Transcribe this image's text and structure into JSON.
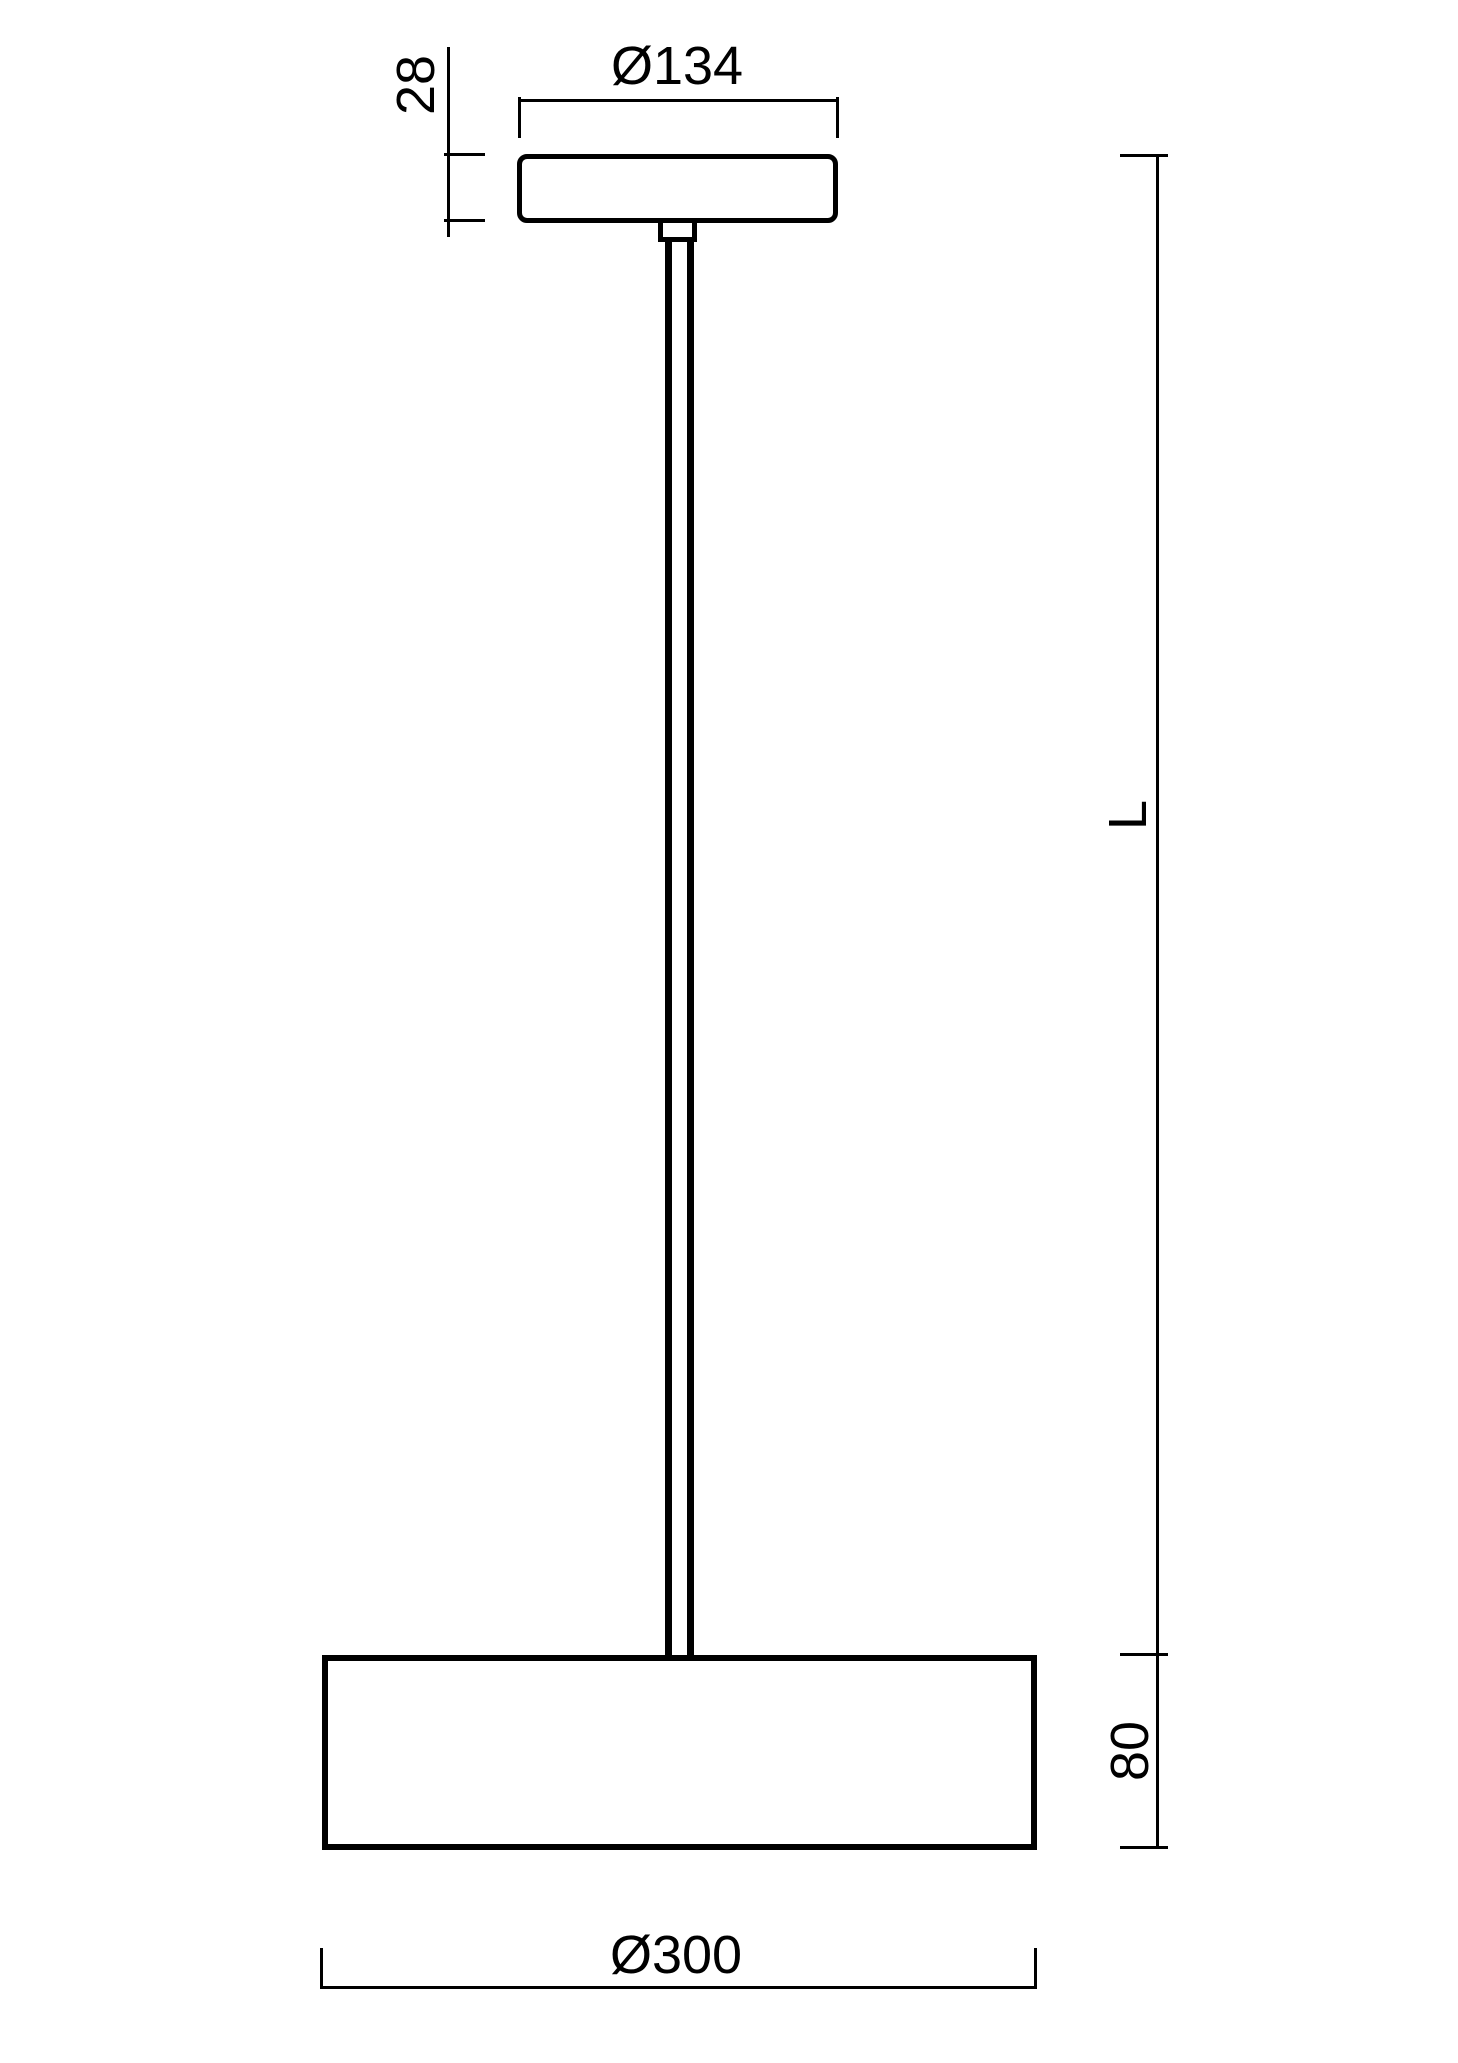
{
  "page": {
    "title": "Pendant luminaire dimension drawing"
  },
  "colors": {
    "line-color": "#000000",
    "bg-color": "#ffffff"
  },
  "dimensions": {
    "canopy_height": "28",
    "canopy_diameter": "Ø134",
    "pendant_length": "L",
    "shade_height": "80",
    "shade_diameter": "Ø300"
  }
}
